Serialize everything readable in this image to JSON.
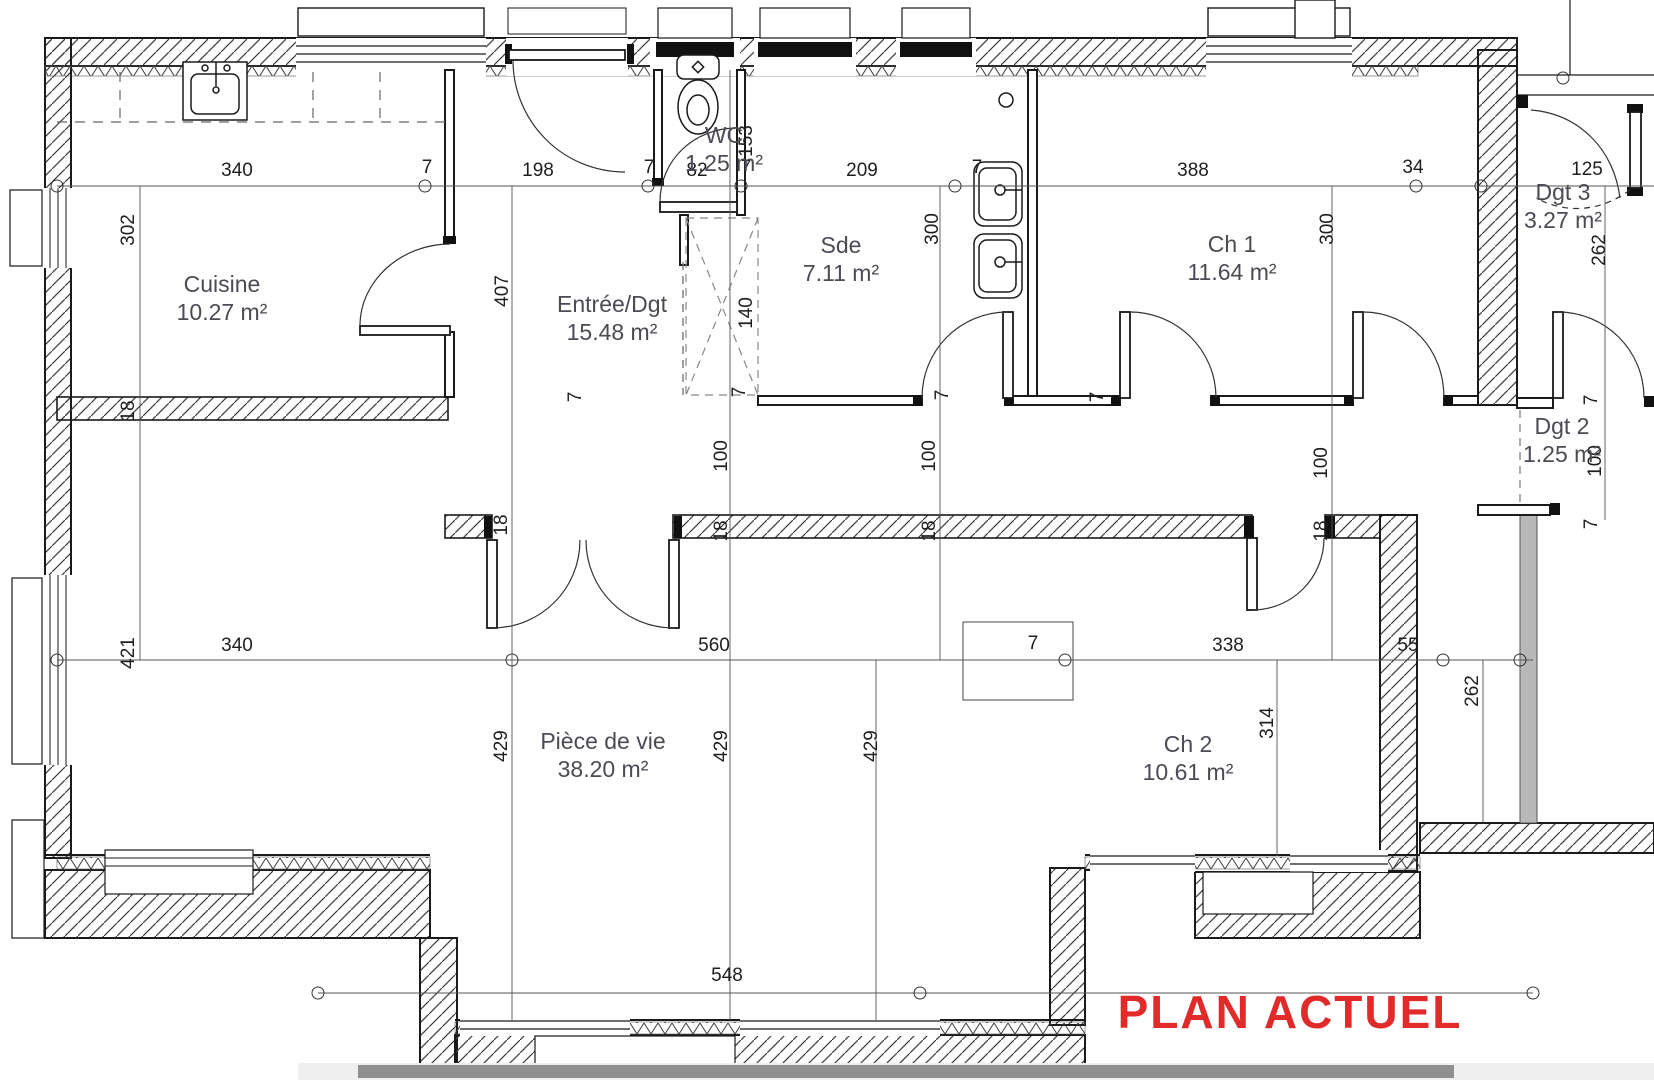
{
  "title": {
    "text": "PLAN ACTUEL",
    "color": "#e12b2b"
  },
  "rooms": [
    {
      "id": "cuisine",
      "name": "Cuisine",
      "area": "10.27 m²",
      "x": 222,
      "y": 292
    },
    {
      "id": "entree-dgt",
      "name": "Entrée/Dgt",
      "area": "15.48 m²",
      "x": 612,
      "y": 312
    },
    {
      "id": "wc",
      "name": "WC",
      "area": "1.25 m²",
      "x": 724,
      "y": 143
    },
    {
      "id": "sde",
      "name": "Sde",
      "area": "7.11 m²",
      "x": 841,
      "y": 253
    },
    {
      "id": "ch1",
      "name": "Ch 1",
      "area": "11.64 m²",
      "x": 1232,
      "y": 252
    },
    {
      "id": "dgt3",
      "name": "Dgt 3",
      "area": "3.27 m²",
      "x": 1563,
      "y": 200
    },
    {
      "id": "dgt2",
      "name": "Dgt 2",
      "area": "1.25 m²",
      "x": 1562,
      "y": 434
    },
    {
      "id": "piece-de-vie",
      "name": "Pièce de vie",
      "area": "38.20 m²",
      "x": 603,
      "y": 749
    },
    {
      "id": "ch2",
      "name": "Ch 2",
      "area": "10.61 m²",
      "x": 1188,
      "y": 752
    }
  ],
  "dimensions": [
    {
      "text": "340",
      "x": 237,
      "y": 176
    },
    {
      "text": "7",
      "x": 427,
      "y": 173
    },
    {
      "text": "198",
      "x": 538,
      "y": 176
    },
    {
      "text": "7",
      "x": 649,
      "y": 173
    },
    {
      "text": "82",
      "x": 697,
      "y": 176
    },
    {
      "text": "7",
      "x": 746,
      "y": 173
    },
    {
      "text": "209",
      "x": 862,
      "y": 176
    },
    {
      "text": "7",
      "x": 977,
      "y": 173
    },
    {
      "text": "388",
      "x": 1193,
      "y": 176
    },
    {
      "text": "34",
      "x": 1413,
      "y": 173
    },
    {
      "text": "125",
      "x": 1587,
      "y": 175
    },
    {
      "text": "302",
      "x": 134,
      "y": 230,
      "rot": true
    },
    {
      "text": "153",
      "x": 752,
      "y": 141,
      "rot": true
    },
    {
      "text": "407",
      "x": 508,
      "y": 291,
      "rot": true
    },
    {
      "text": "140",
      "x": 752,
      "y": 313,
      "rot": true
    },
    {
      "text": "7",
      "x": 745,
      "y": 392,
      "rot": true
    },
    {
      "text": "300",
      "x": 938,
      "y": 229,
      "rot": true
    },
    {
      "text": "300",
      "x": 1333,
      "y": 229,
      "rot": true
    },
    {
      "text": "262",
      "x": 1605,
      "y": 250,
      "rot": true
    },
    {
      "text": "7",
      "x": 1597,
      "y": 400,
      "rot": true
    },
    {
      "text": "100",
      "x": 1601,
      "y": 461,
      "rot": true
    },
    {
      "text": "7",
      "x": 1597,
      "y": 524,
      "rot": true
    },
    {
      "text": "100",
      "x": 727,
      "y": 456,
      "rot": true
    },
    {
      "text": "100",
      "x": 935,
      "y": 456,
      "rot": true
    },
    {
      "text": "100",
      "x": 1327,
      "y": 463,
      "rot": true
    },
    {
      "text": "18",
      "x": 134,
      "y": 411,
      "rot": true
    },
    {
      "text": "18",
      "x": 507,
      "y": 525,
      "rot": true
    },
    {
      "text": "18",
      "x": 727,
      "y": 531,
      "rot": true
    },
    {
      "text": "18",
      "x": 935,
      "y": 531,
      "rot": true
    },
    {
      "text": "18",
      "x": 1327,
      "y": 531,
      "rot": true
    },
    {
      "text": "7",
      "x": 581,
      "y": 397,
      "rot": true
    },
    {
      "text": "7",
      "x": 948,
      "y": 395,
      "rot": true
    },
    {
      "text": "7",
      "x": 1103,
      "y": 397,
      "rot": true
    },
    {
      "text": "421",
      "x": 134,
      "y": 653,
      "rot": true
    },
    {
      "text": "340",
      "x": 237,
      "y": 651
    },
    {
      "text": "560",
      "x": 714,
      "y": 651
    },
    {
      "text": "7",
      "x": 1033,
      "y": 649
    },
    {
      "text": "338",
      "x": 1228,
      "y": 651
    },
    {
      "text": "55",
      "x": 1408,
      "y": 651
    },
    {
      "text": "262",
      "x": 1478,
      "y": 691,
      "rot": true
    },
    {
      "text": "314",
      "x": 1273,
      "y": 723,
      "rot": true
    },
    {
      "text": "429",
      "x": 507,
      "y": 746,
      "rot": true
    },
    {
      "text": "429",
      "x": 727,
      "y": 746,
      "rot": true
    },
    {
      "text": "429",
      "x": 877,
      "y": 746,
      "rot": true
    },
    {
      "text": "548",
      "x": 727,
      "y": 981
    }
  ]
}
